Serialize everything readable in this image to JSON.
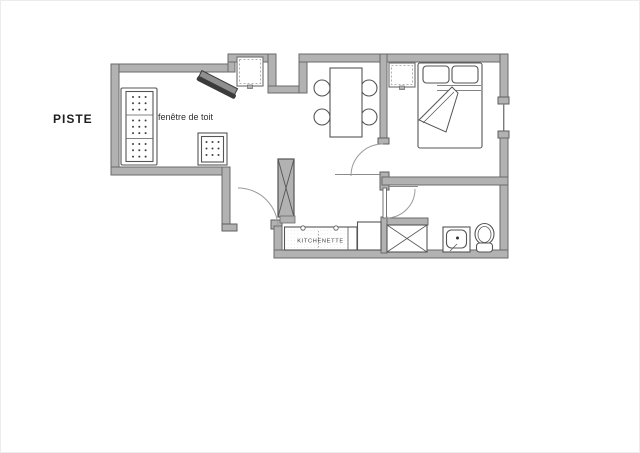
{
  "page": {
    "type": "floor-plan",
    "background": "#ffffff"
  },
  "labels": {
    "piste": "PISTE",
    "roof_window": "fenêtre de toit",
    "kitchenette": "KITCHENETTE"
  },
  "colors": {
    "background": "#ffffff",
    "wall_fill": "#b2b2b2",
    "wall_outline": "#6a6a6a",
    "furniture_line": "#555555",
    "door_arc": "#9a9a9a",
    "upholstery_dot": "#3f3f3f",
    "tv_body": "#3b3b3b",
    "tv_top": "#8f8f8f",
    "label_text": "#1f1f1f"
  },
  "fixtures": [
    "sofa",
    "ottoman",
    "television",
    "roof-window-recess",
    "roof-window-bedroom",
    "dining-table",
    "dining-chairs-x4",
    "double-bed",
    "pillows-x2",
    "folded-duvet",
    "technical-column",
    "entrance-door",
    "bedroom-door",
    "bathroom-door",
    "kitchenette-counter",
    "shower",
    "washbasin",
    "toilet",
    "bedroom-window"
  ]
}
